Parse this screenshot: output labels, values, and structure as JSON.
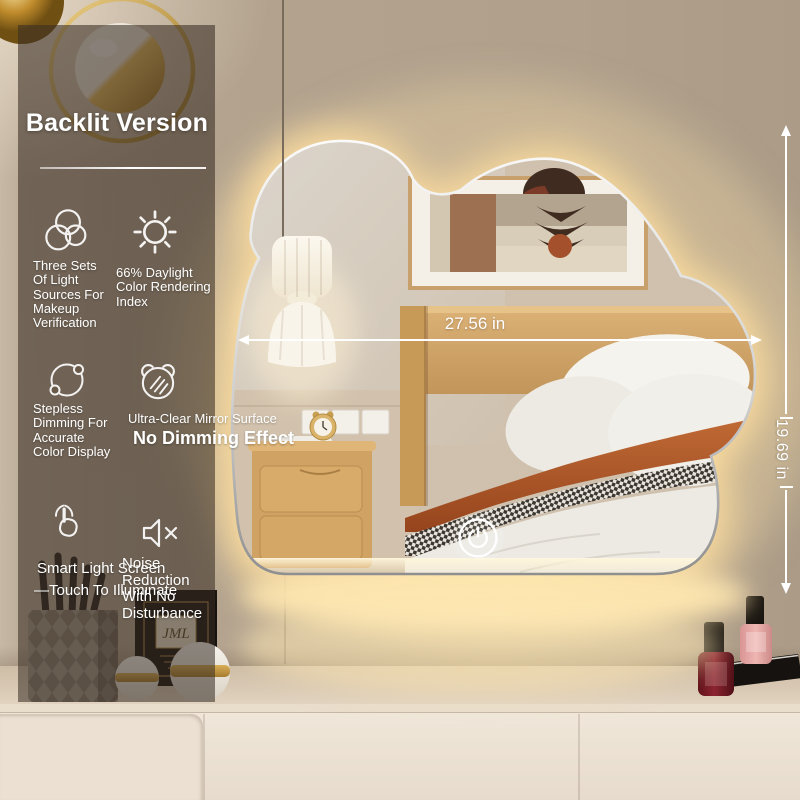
{
  "overlay": {
    "title": "Backlit Version",
    "features": [
      {
        "icon": "three-circles-icon",
        "label": "Three Sets Of Light Sources For Makeup Verification"
      },
      {
        "icon": "sun-icon",
        "label": "66% Daylight Color Rendering Index"
      },
      {
        "icon": "stepless-dimmer-icon",
        "label": "Stepless Dimming For Accurate Color Display"
      },
      {
        "icon": "bear-mirror-icon",
        "label": "Ultra-Clear Mirror Surface",
        "sublabel": "No Dimming Effect"
      },
      {
        "icon": "touch-gesture-icon",
        "label": "Smart Light Screen",
        "sublabel": "—Touch To Illuminate"
      },
      {
        "icon": "mute-speaker-icon",
        "label": "Noise Reduction With No Disturbance"
      }
    ]
  },
  "dimensions": {
    "width_label": "27.56 in",
    "height_label": "19.69 in"
  },
  "colors": {
    "glow": "#ffe2a6",
    "panel_overlay": "rgba(56,44,34,0.56)",
    "wall": "#b3a390",
    "accent_gold": "#c9952e",
    "frame_silver": "#e5e5e5",
    "terracotta": "#b05a2c"
  }
}
